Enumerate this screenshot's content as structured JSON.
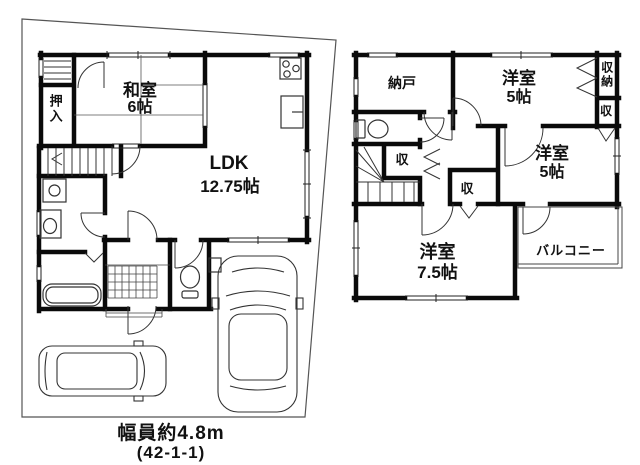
{
  "floor1": {
    "rooms": {
      "washitsu_label": "和室",
      "washitsu_size": "6帖",
      "oshiire_label": "押入",
      "ldk_label": "LDK",
      "ldk_size": "12.75帖"
    },
    "caption": {
      "road_width": "幅員約4.8m",
      "lot_number": "(42-1-1)"
    }
  },
  "floor2": {
    "rooms": {
      "nando_label": "納戸",
      "bedroom1_label": "洋室",
      "bedroom1_size": "5帖",
      "closet_tall_label": "収納",
      "closet_right_label": "収",
      "bedroom2_label": "洋室",
      "bedroom2_size": "5帖",
      "closet_mid_label": "収",
      "closet_stairs_label": "収",
      "bedroom3_label": "洋室",
      "bedroom3_size": "7.5帖",
      "balcony_label": "バルコニー"
    }
  },
  "colors": {
    "wall": "#0a0a0a",
    "thin_line": "#222222",
    "boundary": "#555555"
  }
}
